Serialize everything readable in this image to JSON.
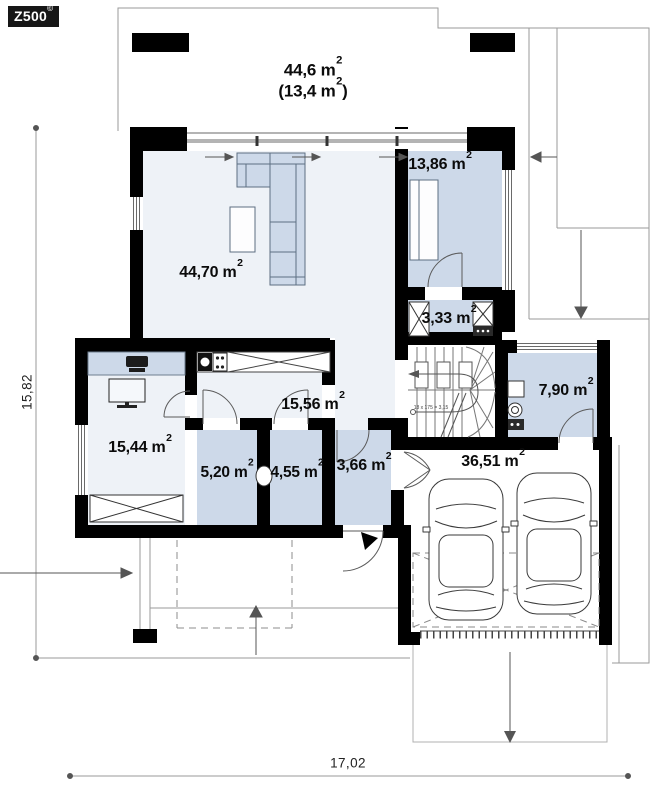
{
  "logo": {
    "text": "Z500",
    "mark": "©"
  },
  "plan": {
    "terrace": {
      "area": "44,6 m²",
      "area_secondary": "(13,4 m²)"
    },
    "rooms": {
      "living_room": "44,70 m²",
      "bedroom": "13,86 m²",
      "dressing": "3,33 m²",
      "bathroom": "7,90 m²",
      "hall": "15,56 m²",
      "office": "15,44 m²",
      "wc": "5,20 m²",
      "pantry": "4,55 m²",
      "vestibule": "3,66 m²",
      "garage": "36,51 m²"
    },
    "stairs_note": "18 x 175 = 3,15",
    "dimensions": {
      "total_width": "17,02",
      "total_height": "15,82"
    }
  }
}
